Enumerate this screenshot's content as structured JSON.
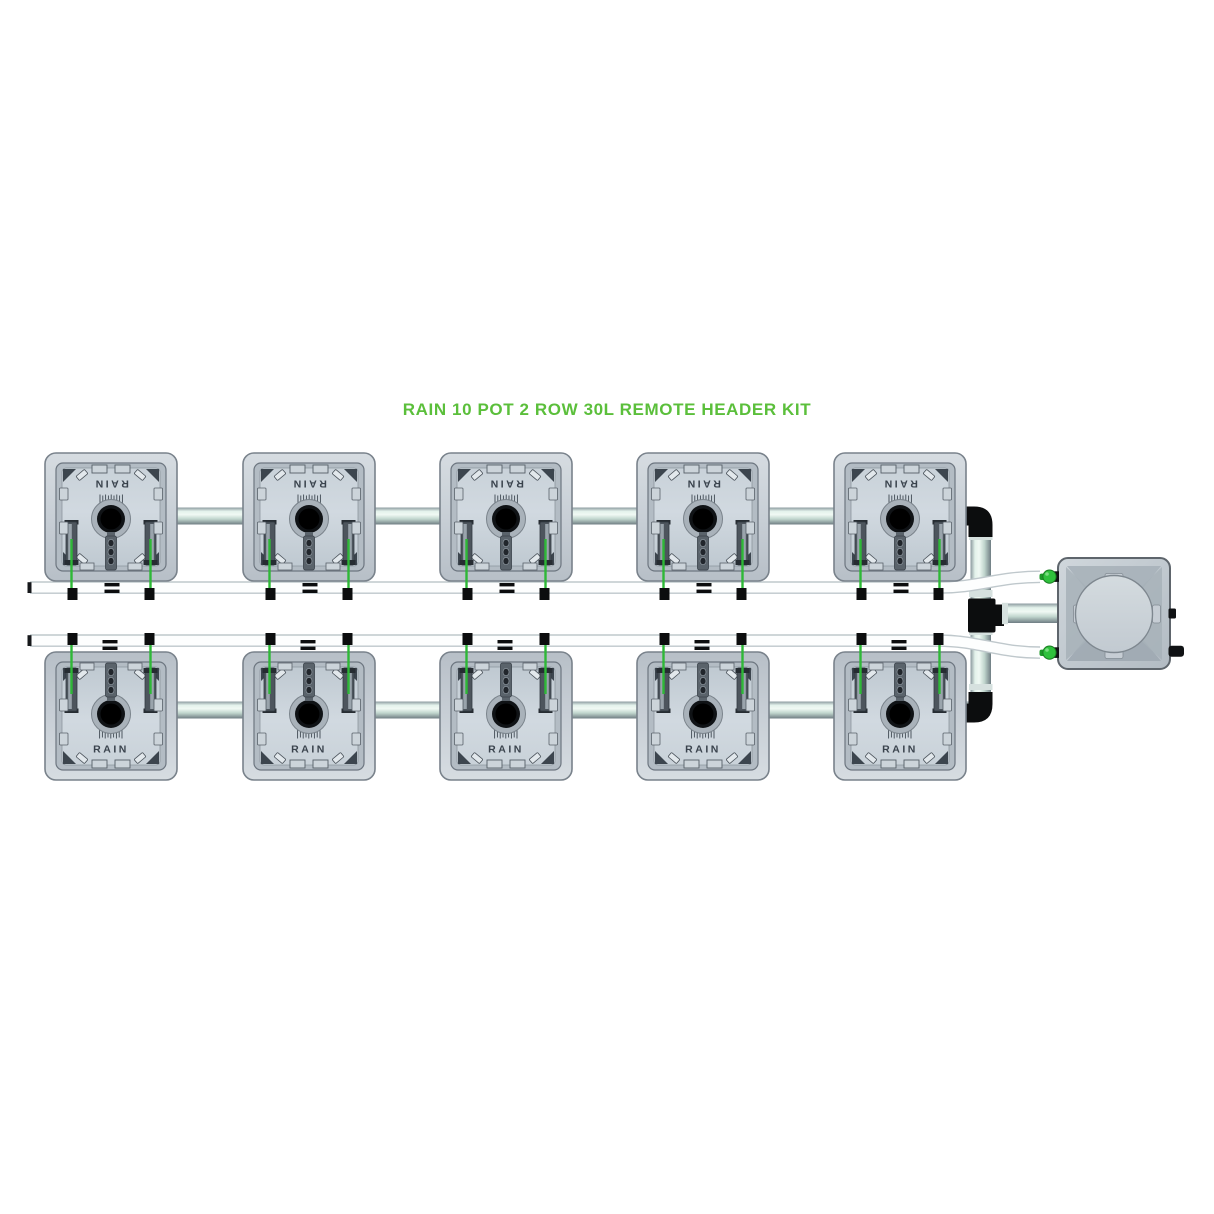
{
  "title": "RAIN 10 POT 2 ROW 30L REMOTE HEADER KIT",
  "pot": {
    "label": "RAIN"
  },
  "system": {
    "pot_count": 10,
    "rows": 2,
    "pots_per_row": 5,
    "colors": {
      "title_green": "#5bbf3b",
      "dripper_green": "#2eb837",
      "inlet_fitting_green": "#2fc13c",
      "pipe_highlight": "#e3f2eb",
      "pot_body_gray": "#c5ced6",
      "fitting_black": "#0c0d0e",
      "tube_white": "#fdfefe"
    }
  }
}
